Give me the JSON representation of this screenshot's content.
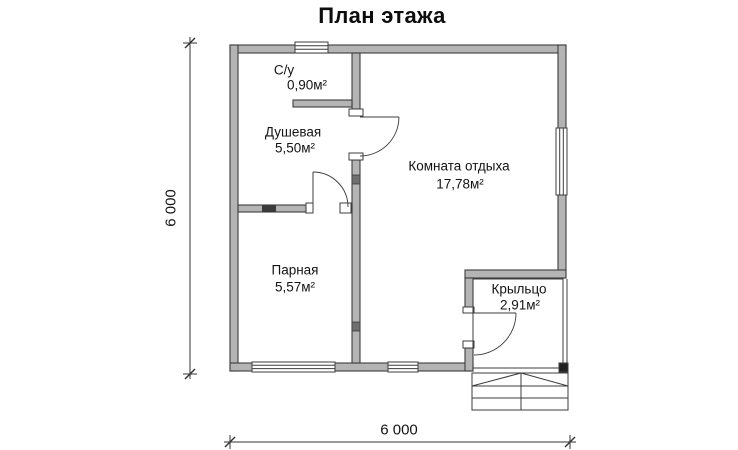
{
  "title": "План этажа",
  "rooms": [
    {
      "name": "С/у",
      "area": "0,90м²"
    },
    {
      "name": "Душевая",
      "area": "5,50м²"
    },
    {
      "name": "Комната отдыха",
      "area": "17,78м²"
    },
    {
      "name": "Парная",
      "area": "5,57м²"
    },
    {
      "name": "Крыльцо",
      "area": "2,91м²"
    }
  ],
  "dimensions": {
    "overall_width": "6 000",
    "overall_height": "6 000"
  },
  "colors": {
    "wall_fill": "#b4b4b4",
    "line": "#3d3d3d",
    "text": "#111111"
  }
}
